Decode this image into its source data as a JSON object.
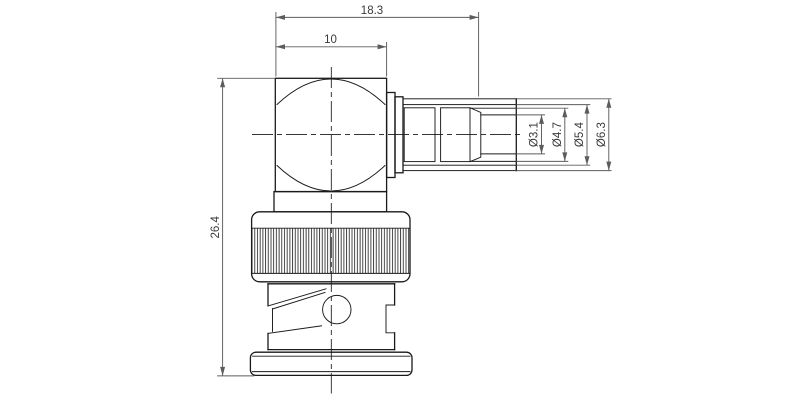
{
  "drawing": {
    "colors": {
      "bg": "#ffffff",
      "outline": "#1a1a1a",
      "dim": "#5c5c5c",
      "text": "#3a3a3a"
    },
    "dims": {
      "overall_length": "18.3",
      "body_width": "10",
      "overall_height": "26.4",
      "dia_bore": "Ø3.1",
      "dia_ferrule": "Ø4.7",
      "dia_tube_inner": "Ø5.4",
      "dia_tube_outer": "Ø6.3"
    }
  }
}
